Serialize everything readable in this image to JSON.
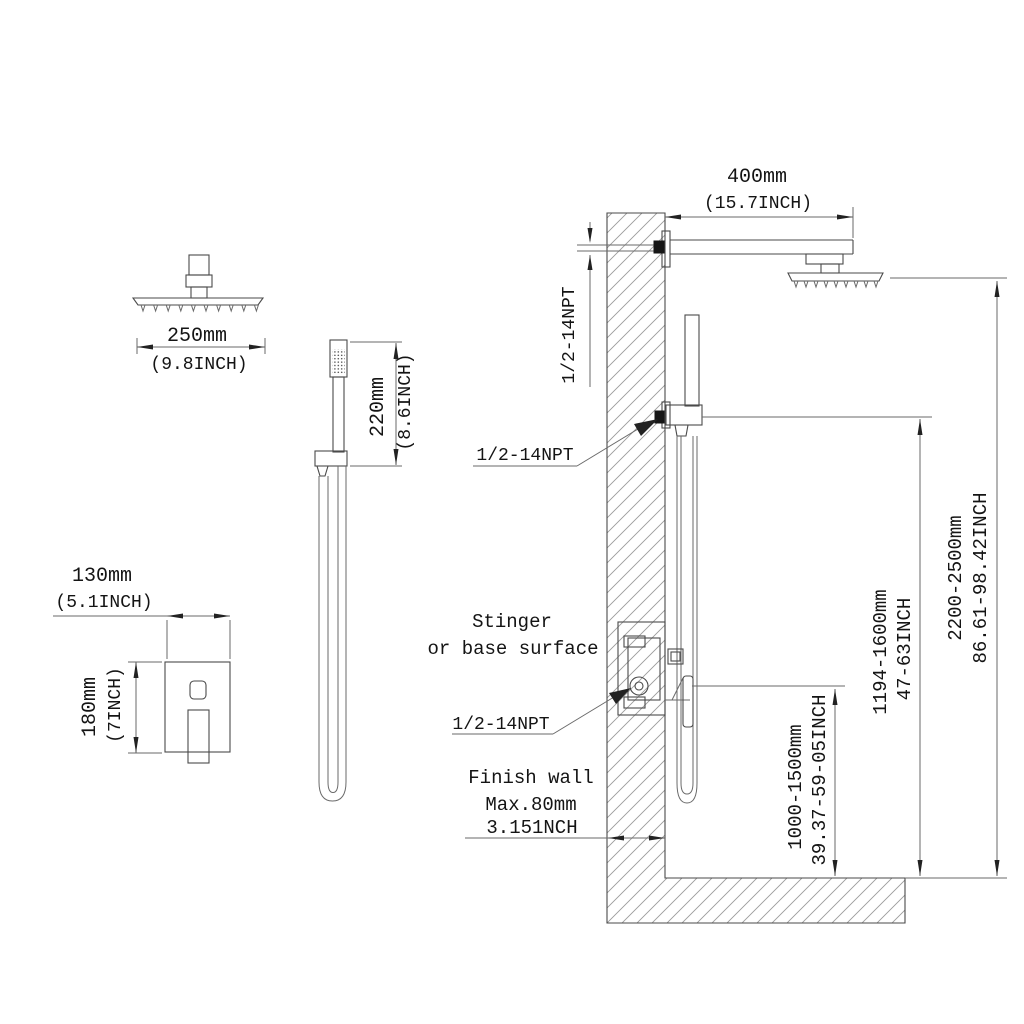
{
  "diagram": {
    "background": "#ffffff",
    "line_color": "#4a4a4a",
    "text_color": "#141414",
    "overhead_shower": {
      "width_mm": "250mm",
      "width_inch": "(9.8INCH)"
    },
    "hand_shower": {
      "length_mm": "220mm",
      "length_inch": "(8.6INCH)"
    },
    "valve_trim": {
      "width_mm": "130mm",
      "width_inch": "(5.1INCH)",
      "height_mm": "180mm",
      "height_inch": "(7INCH)"
    },
    "installation": {
      "arm_length_mm": "400mm",
      "arm_length_inch": "(15.7INCH)",
      "thread_top": "1/2-14NPT",
      "thread_mid": "1/2-14NPT",
      "thread_bottom": "1/2-14NPT",
      "surface_note_line1": "Stinger",
      "surface_note_line2": "or base surface",
      "wall_note_line1": "Finish wall",
      "wall_note_line2": "Max.80mm",
      "wall_note_line3": "3.151NCH",
      "height_hose_mm": "1000-1500mm",
      "height_hose_inch": "39.37-59-05INCH",
      "height_slidebar_mm": "1194-1600mm",
      "height_slidebar_inch": "47-63INCH",
      "height_showerhead_mm": "2200-2500mm",
      "height_showerhead_inch": "86.61-98.42INCH"
    }
  }
}
